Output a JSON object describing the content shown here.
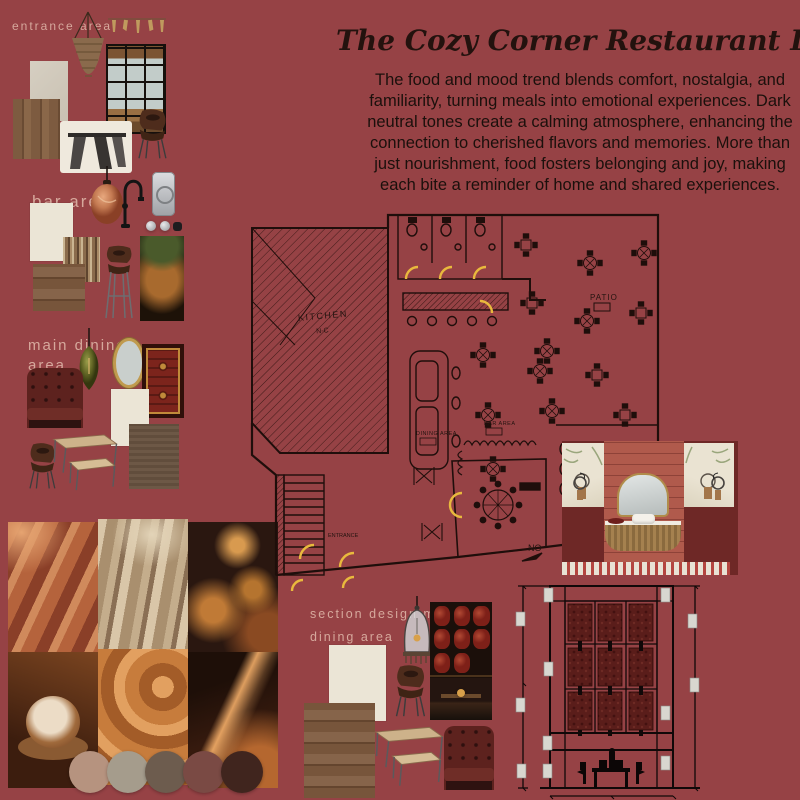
{
  "colors": {
    "background": "#964245",
    "door_accent": "#e9b93d",
    "panel_red": "#5a1d1a",
    "label_pink": "#ddb4a6"
  },
  "header": {
    "title": "The Cozy Corner Restaurant Design",
    "description": "The food and mood trend blends comfort, nostalgia, and familiarity, turning meals into emotional experiences. Dark neutral tones create a calming atmosphere, enhancing the connection to cherished flavors and memories. More than just nourishment, food fosters belonging and joy, making each bite a reminder of home and shared experiences."
  },
  "labels": {
    "entrance": "entrance area",
    "bar": "bar area",
    "main_dining": {
      "line1": "main dining",
      "line2": "area"
    },
    "section": {
      "line1": "section design main",
      "line2": "dining area"
    }
  },
  "floor_plan": {
    "kitchen": "KITCHEN",
    "kitchen_sub": "N-C",
    "dining": "DINING AREA",
    "bar": "BAR AREA",
    "patio": "PATIO",
    "entrance": "ENTRANCE",
    "north": "NO"
  },
  "palette": [
    "#b6937f",
    "#a59c8c",
    "#6d5c4e",
    "#7a4a44",
    "#40251e"
  ]
}
